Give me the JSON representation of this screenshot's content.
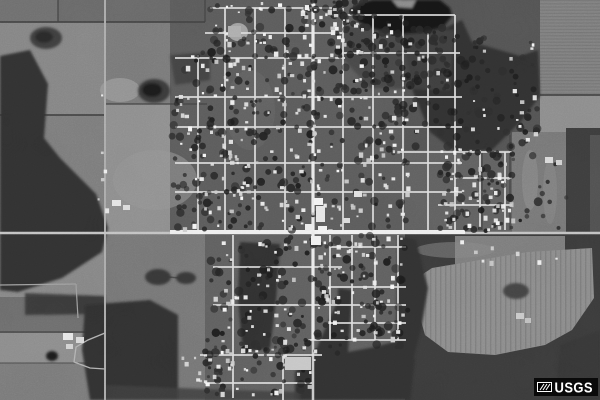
{
  "watermark": {
    "text": "USGS",
    "bg": "#0a0a0a",
    "fg": "#ffffff"
  },
  "scene": {
    "w": 600,
    "h": 400,
    "seed": 20,
    "palette": {
      "base": "#6e6e6e",
      "woods": "#333333",
      "pond": "#161616",
      "ruralRoad": "#aeaeae",
      "street": "#e0e0e0",
      "mainRoad": "#f1f1f1",
      "hedge": "#454545"
    },
    "fields": [
      [
        0,
        0,
        58,
        22,
        "#717171"
      ],
      [
        58,
        0,
        112,
        22,
        "#6b6b6b"
      ],
      [
        0,
        22,
        105,
        93,
        "#878787"
      ],
      [
        105,
        22,
        105,
        82,
        "#7b7b7b"
      ],
      [
        0,
        115,
        105,
        120,
        "#7e7e7e"
      ],
      [
        105,
        104,
        102,
        128,
        "#909090"
      ],
      [
        0,
        235,
        105,
        62,
        "#898989"
      ],
      [
        0,
        320,
        105,
        13,
        "#6f6f6f"
      ],
      [
        0,
        333,
        105,
        30,
        "#8e8e8e"
      ],
      [
        0,
        363,
        105,
        37,
        "#7c7c7c"
      ],
      [
        105,
        232,
        100,
        168,
        "#787878"
      ],
      [
        170,
        0,
        235,
        232,
        "#5d5d5d"
      ],
      [
        405,
        0,
        135,
        150,
        "#555555"
      ],
      [
        405,
        150,
        107,
        82,
        "#626262"
      ],
      [
        540,
        0,
        60,
        95,
        "#828282",
        "h"
      ],
      [
        540,
        95,
        60,
        55,
        "#8f8f8f"
      ],
      [
        512,
        132,
        55,
        100,
        "#797979"
      ],
      [
        566,
        128,
        34,
        187,
        "#3e3e3e"
      ],
      [
        590,
        135,
        10,
        180,
        "#525252"
      ],
      [
        205,
        232,
        200,
        168,
        "#616161"
      ],
      [
        405,
        232,
        195,
        168,
        "#3c3c3c"
      ],
      [
        455,
        236,
        110,
        28,
        "#7e7e7e"
      ],
      [
        585,
        290,
        15,
        110,
        "#3c3c3c"
      ]
    ],
    "seField": {
      "points": "432,268 528,252 592,248 594,298 572,330 545,345 495,355 448,352 425,335 415,300 420,276",
      "fill": "#8e8e8e",
      "pattern": "v"
    },
    "lightPatches": [
      [
        120,
        90,
        20,
        12,
        "#9c9c9c",
        0.8
      ],
      [
        155,
        180,
        42,
        30,
        "#989898",
        0.55
      ],
      [
        530,
        180,
        8,
        30,
        "#8e8e8e",
        0.6
      ],
      [
        550,
        192,
        7,
        32,
        "#8a8a8a",
        0.5
      ],
      [
        30,
        262,
        25,
        11,
        "#949494",
        0.5
      ],
      [
        470,
        62,
        18,
        8,
        "#7f7f7f",
        0.7
      ],
      [
        238,
        32,
        10,
        9,
        "#ababab",
        0.9
      ],
      [
        250,
        110,
        25,
        40,
        "#6a6a6a",
        0.5
      ],
      [
        455,
        250,
        40,
        8,
        "#8a8a8a",
        0.5
      ]
    ],
    "hedges": [
      [
        0,
        22,
        205,
        22,
        2
      ],
      [
        58,
        0,
        58,
        22,
        1.5
      ],
      [
        0,
        115,
        105,
        115,
        2
      ],
      [
        105,
        104,
        207,
        104,
        1.5
      ],
      [
        540,
        95,
        600,
        95,
        2
      ],
      [
        0,
        332,
        105,
        332,
        1.5
      ],
      [
        0,
        363,
        105,
        363,
        1
      ],
      [
        482,
        152,
        482,
        230,
        1.5
      ],
      [
        205,
        0,
        205,
        22,
        1.5
      ],
      [
        510,
        135,
        510,
        230,
        1.5
      ],
      [
        168,
        277,
        180,
        278,
        1.5
      ]
    ],
    "woods": [
      {
        "p": "0,56 30,50 48,84 44,138 60,158 96,194 108,228 102,252 62,278 18,292 0,290"
      },
      {
        "p": "25,293 105,296 105,314 25,315",
        "o": 0.85
      },
      {
        "p": "85,305 150,300 178,315 178,400 90,400 82,350"
      },
      {
        "p": "240,242 280,244 276,300 270,348 243,352 238,300"
      },
      {
        "p": "295,372 315,352 338,300 338,288 352,290 348,352 375,347 408,338 415,360 410,400 295,400"
      },
      {
        "p": "402,0 425,6 445,28 462,20 472,42 520,56 538,50 540,96 522,120 492,150 456,152 430,132 413,92 403,42"
      },
      {
        "p": "345,26 455,30 450,90 370,88 342,58",
        "f": "#454545",
        "o": 0.8
      },
      {
        "p": "398,236 416,240 428,288 421,330 406,386 396,340"
      },
      {
        "p": "105,385 230,390 300,392 300,400 105,400",
        "f": "#3e3e3e",
        "o": 0.85
      },
      {
        "p": "170,55 210,52 210,80 175,85",
        "o": 0.6
      },
      {
        "p": "560,345 600,330 600,400 555,400",
        "f": "#383838"
      }
    ],
    "ponds": [
      {
        "p": "350,10 360,3 372,0 440,0 450,8 452,16 444,26 424,32 398,34 374,29 358,22",
        "f": "#161616"
      },
      {
        "p": "392,0 416,0 412,8 398,7",
        "f": "#8c8c8c"
      },
      {
        "e": [
          154,
          91,
          16,
          12
        ],
        "f": "#3a3a3a"
      },
      {
        "e": [
          152,
          90,
          10,
          7
        ],
        "f": "#1d1d1d"
      },
      {
        "e": [
          46,
          38,
          16,
          11
        ],
        "f": "#3f3f3f"
      },
      {
        "e": [
          44,
          37,
          9,
          6
        ],
        "f": "#2a2a2a"
      },
      {
        "e": [
          158,
          277,
          13,
          8
        ],
        "f": "#383838"
      },
      {
        "e": [
          186,
          278,
          10,
          6
        ],
        "f": "#383838"
      },
      {
        "e": [
          516,
          291,
          13,
          8
        ],
        "f": "#454545"
      },
      {
        "e": [
          52,
          356,
          6,
          5
        ],
        "f": "#1f1f1f"
      }
    ],
    "roads": [
      [
        105,
        0,
        105,
        400,
        2,
        "#aeaeae"
      ],
      [
        313,
        0,
        313,
        400,
        2.5,
        "#cccccc"
      ],
      [
        0,
        233,
        600,
        233,
        2.5,
        "#c6c6c6"
      ],
      [
        0,
        285,
        76,
        284,
        1.2,
        "#a2a2a2"
      ]
    ],
    "lanes": [
      {
        "pts": "105,333 88,340 76,347 74,362 90,368 105,369",
        "w": 1.3,
        "c": "#b5b5b5"
      },
      {
        "pts": "76,284 78,318",
        "w": 1.2,
        "c": "#a2a2a2"
      }
    ],
    "mains": [
      [
        170,
        232,
        465,
        232,
        4,
        "#f2f2f2"
      ],
      [
        313,
        2,
        313,
        340,
        3.2,
        "#ececec"
      ]
    ],
    "streetsH": [
      [
        210,
        332,
        8
      ],
      [
        330,
        455,
        15
      ],
      [
        205,
        342,
        33
      ],
      [
        342,
        460,
        53
      ],
      [
        175,
        345,
        58
      ],
      [
        175,
        462,
        97
      ],
      [
        175,
        462,
        127
      ],
      [
        398,
        512,
        152
      ],
      [
        175,
        462,
        163
      ],
      [
        455,
        512,
        178
      ],
      [
        175,
        462,
        192
      ],
      [
        438,
        512,
        205
      ],
      [
        330,
        406,
        247
      ],
      [
        213,
        342,
        267
      ],
      [
        330,
        406,
        287
      ],
      [
        213,
        406,
        305
      ],
      [
        330,
        406,
        323
      ],
      [
        308,
        406,
        340
      ],
      [
        200,
        322,
        355
      ],
      [
        205,
        312,
        383
      ]
    ],
    "streetsV": [
      [
        55,
        230,
        198
      ],
      [
        8,
        230,
        225
      ],
      [
        8,
        230,
        255
      ],
      [
        8,
        230,
        285
      ],
      [
        8,
        230,
        343
      ],
      [
        15,
        230,
        373
      ],
      [
        15,
        230,
        403
      ],
      [
        33,
        230,
        428
      ],
      [
        15,
        230,
        455
      ],
      [
        150,
        230,
        480
      ],
      [
        152,
        230,
        505
      ],
      [
        235,
        398,
        233
      ],
      [
        235,
        340,
        330
      ],
      [
        235,
        340,
        352
      ],
      [
        235,
        340,
        375
      ],
      [
        235,
        340,
        398
      ],
      [
        355,
        400,
        283
      ]
    ],
    "landmarks": [
      [
        314,
        198,
        9,
        7,
        "#f4f4f4"
      ],
      [
        316,
        206,
        9,
        16,
        "#e8e8e8"
      ],
      [
        305,
        224,
        8,
        7,
        "#efefef"
      ],
      [
        318,
        226,
        9,
        7,
        "#f4f4f4"
      ],
      [
        311,
        236,
        10,
        9,
        "#f0f0f0"
      ],
      [
        285,
        357,
        26,
        13,
        "#c9c9c9"
      ],
      [
        63,
        333,
        10,
        7,
        "#e9e9e9"
      ],
      [
        76,
        337,
        8,
        6,
        "#dcdcdc"
      ],
      [
        66,
        344,
        7,
        5,
        "#d5d5d5"
      ],
      [
        112,
        200,
        9,
        6,
        "#e8e8e8"
      ],
      [
        123,
        205,
        7,
        5,
        "#dedede"
      ],
      [
        545,
        157,
        8,
        6,
        "#dcdcdc"
      ],
      [
        556,
        160,
        6,
        5,
        "#d2d2d2"
      ],
      [
        516,
        313,
        8,
        6,
        "#cccccc"
      ],
      [
        525,
        318,
        6,
        5,
        "#c2c2c2"
      ],
      [
        228,
        26,
        13,
        11,
        "#b0b0b0"
      ],
      [
        354,
        191,
        8,
        6,
        "#e4e4e4"
      ],
      [
        343,
        218,
        7,
        5,
        "#dedede"
      ]
    ],
    "houses": {
      "sizes": [
        2,
        4.5
      ],
      "fills": [
        "#f2f2f2",
        "#e2e2e2",
        "#cfcfcf",
        "#fafafa"
      ],
      "regions": [
        [
          212,
          8,
          196,
          222,
          215
        ],
        [
          175,
          55,
          36,
          175,
          26
        ],
        [
          408,
          40,
          130,
          108,
          24
        ],
        [
          440,
          148,
          72,
          82,
          55
        ],
        [
          300,
          2,
          62,
          26,
          13
        ],
        [
          210,
          0,
          130,
          9,
          8
        ],
        [
          213,
          236,
          92,
          118,
          44
        ],
        [
          316,
          236,
          88,
          102,
          58
        ],
        [
          203,
          344,
          118,
          52,
          30
        ],
        [
          180,
          350,
          26,
          42,
          8
        ],
        [
          95,
          90,
          14,
          120,
          6
        ],
        [
          460,
          240,
          100,
          22,
          8
        ]
      ]
    },
    "trees": {
      "rmin": 1.5,
      "rmax": 4.5,
      "fills": [
        "#232323",
        "#2e2e2e",
        "#1d1d1d"
      ],
      "regions": [
        [
          208,
          4,
          200,
          226,
          250
        ],
        [
          172,
          52,
          42,
          180,
          48
        ],
        [
          404,
          36,
          136,
          116,
          90
        ],
        [
          440,
          146,
          74,
          86,
          55
        ],
        [
          210,
          234,
          198,
          124,
          150
        ],
        [
          200,
          340,
          122,
          58,
          46
        ],
        [
          336,
          24,
          122,
          68,
          80
        ],
        [
          480,
          150,
          88,
          84,
          20
        ],
        [
          300,
          0,
          70,
          28,
          22
        ]
      ]
    }
  }
}
